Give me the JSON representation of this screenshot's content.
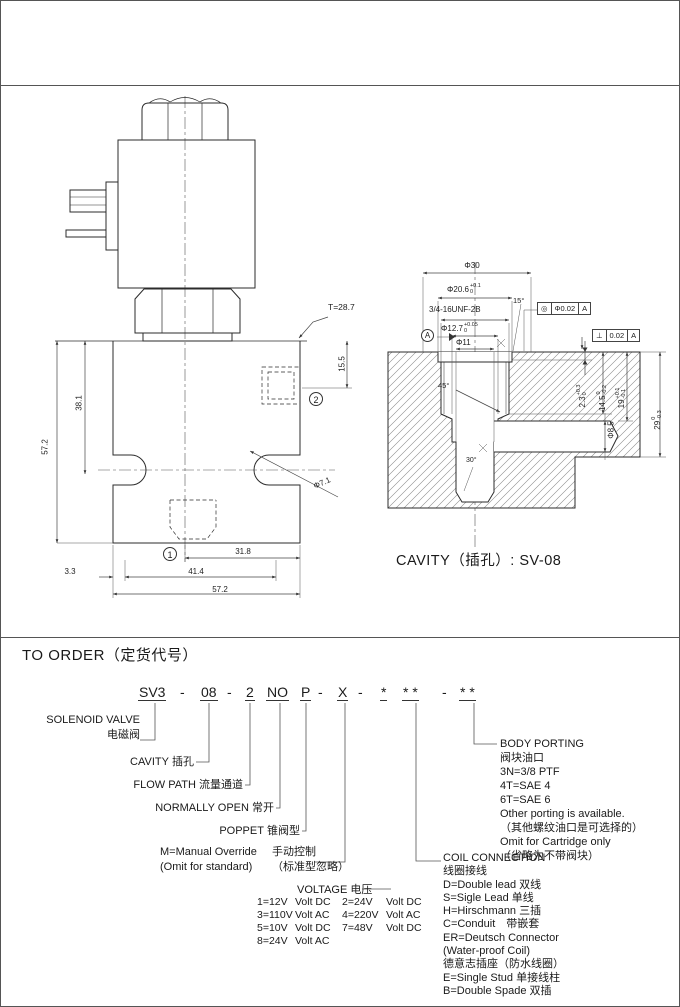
{
  "valve": {
    "t_note": "T=28.7",
    "dim_height": "57.2",
    "dim_h38": "38.1",
    "dim_155": "15.5",
    "dim_port": "Φ7.1",
    "dim_318": "31.8",
    "dim_33": "3.3",
    "dim_414": "41.4",
    "dim_width": "57.2",
    "mark1": "1",
    "mark2": "2"
  },
  "cavity": {
    "caption": "CAVITY（插孔）: SV-08",
    "d30": "Φ30",
    "d206": {
      "v": "Φ20.6",
      "up": "+0.1",
      "lo": "0"
    },
    "thread": "3/4-16UNF-2B",
    "d127": {
      "v": "Φ12.7",
      "up": "+0.05",
      "lo": "0"
    },
    "d11": "Φ11",
    "datum": "A",
    "a15": "15°",
    "a45": "45°",
    "a30": "30°",
    "d23": {
      "v": "2.3",
      "up": "+0.3",
      "lo": "0"
    },
    "d145": {
      "v": "14.5",
      "up": "0",
      "lo": "-0.2"
    },
    "d19": {
      "v": "19",
      "up": "+0.1",
      "lo": "-0.1"
    },
    "d85": "Φ8.5",
    "d29": {
      "v": "29",
      "up": "0",
      "lo": "-0.3"
    },
    "gdt_conc": {
      "sym": "◎",
      "tol": "Φ0.02",
      "datum": "A"
    },
    "gdt_perp": {
      "sym": "⊥",
      "tol": "0.02",
      "datum": "A"
    }
  },
  "order": {
    "title": "TO ORDER（定货代号）",
    "code": {
      "s0": "SV3",
      "s1": "-",
      "s2": "08",
      "s3": "-",
      "s4": "2",
      "s5": "NO",
      "s6": "P",
      "s7": "-",
      "s8": "X",
      "s9": "-",
      "s10": "*",
      "s11": "* *",
      "s12": "-",
      "s13": "* *"
    },
    "f1_en": "SOLENOID VALVE",
    "f1_zh": "电磁阀",
    "f2_en": "CAVITY",
    "f2_zh": "插孔",
    "f3_en": "FLOW PATH",
    "f3_zh": "流量通道",
    "f4_en": "NORMALLY OPEN",
    "f4_zh": "常开",
    "f5_en": "POPPET",
    "f5_zh": "锥阀型",
    "manual_en1": "M=Manual Override",
    "manual_en2": "(Omit for standard)",
    "manual_zh1": "手动控制",
    "manual_zh2": "（标准型忽略）",
    "voltage_title_en": "VOLTAGE",
    "voltage_title_zh": "电压",
    "voltage": {
      "r0": [
        "1=12V",
        "Volt DC",
        "2=24V",
        "Volt DC"
      ],
      "r1": [
        "3=110V",
        "Volt AC",
        "4=220V",
        "Volt AC"
      ],
      "r2": [
        "5=10V",
        "Volt DC",
        "7=48V",
        "Volt DC"
      ],
      "r3": [
        "8=24V",
        "Volt AC",
        "",
        ""
      ]
    },
    "body_porting": [
      "BODY PORTING",
      "阀块油口",
      "3N=3/8 PTF",
      "4T=SAE 4",
      "6T=SAE 6",
      "Other porting is available.",
      "（其他螺纹油口是可选择的）",
      "Omit for Cartridge only",
      "（省略为不带阀块）"
    ],
    "coil_connection": [
      "COIL CONNECTION",
      "线圈接线",
      "D=Double lead 双线",
      "S=Sigle Lead 单线",
      "H=Hirschmann 三插",
      "C=Conduit　带嵌套",
      "ER=Deutsch Connector",
      "(Water-proof Coil)",
      "德意志插座（防水线圈）",
      "E=Single Stud 单接线柱",
      "B=Double Spade 双插"
    ]
  }
}
